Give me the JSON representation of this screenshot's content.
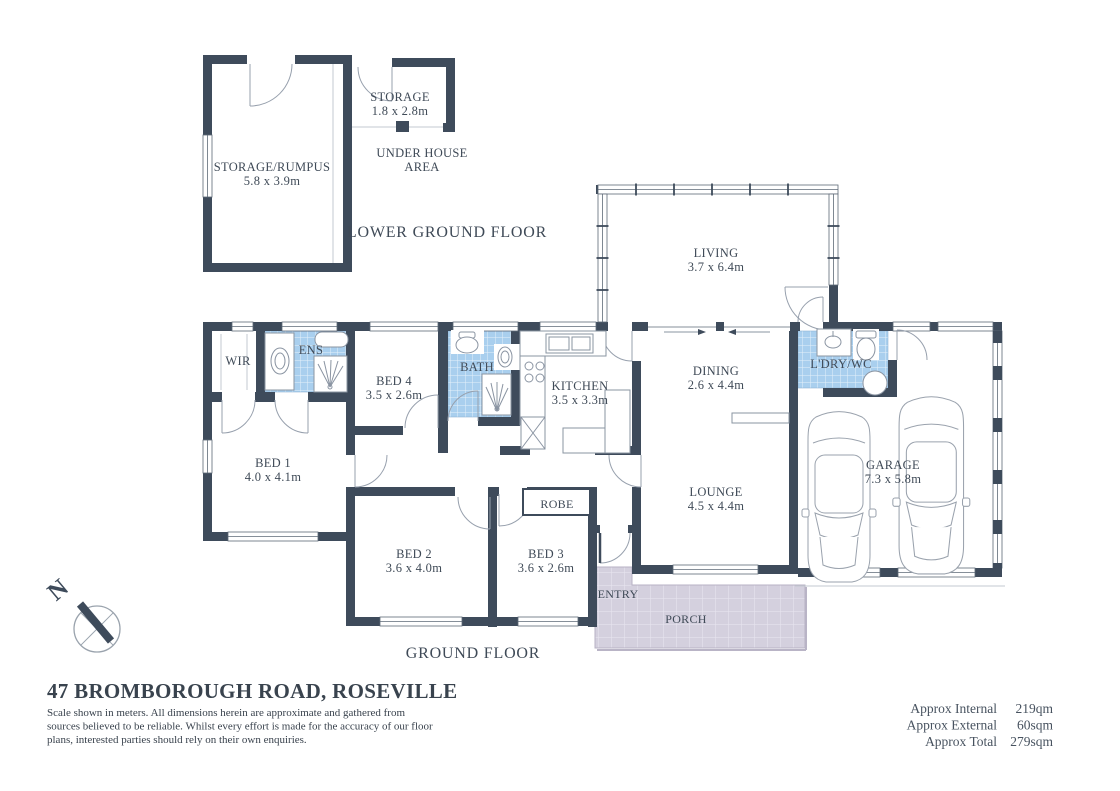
{
  "title": {
    "address": "47 BROMBOROUGH ROAD, ROSEVILLE"
  },
  "disclaimer": {
    "line1": "Scale shown in meters. All dimensions herein are approximate and gathered from",
    "line2": "sources believed to be reliable. Whilst every effort is made for the accuracy of our floor",
    "line3": "plans, interested parties should rely on their own enquiries."
  },
  "area_summary": {
    "internal": {
      "label": "Approx Internal",
      "value": "219qm"
    },
    "external": {
      "label": "Approx External",
      "value": "60sqm"
    },
    "total": {
      "label": "Approx Total",
      "value": "279sqm"
    }
  },
  "floor_labels": {
    "lower": "LOWER GROUND FLOOR",
    "ground": "GROUND FLOOR"
  },
  "compass": {
    "north": "N"
  },
  "rooms": {
    "storage_rumpus": {
      "name": "STORAGE/RUMPUS",
      "dim": "5.8 x 3.9m"
    },
    "storage": {
      "name": "STORAGE",
      "dim": "1.8 x 2.8m"
    },
    "under_house": {
      "line1": "UNDER HOUSE",
      "line2": "AREA"
    },
    "living": {
      "name": "LIVING",
      "dim": "3.7 x 6.4m"
    },
    "dining": {
      "name": "DINING",
      "dim": "2.6 x 4.4m"
    },
    "kitchen": {
      "name": "KITCHEN",
      "dim": "3.5 x 3.3m"
    },
    "lounge": {
      "name": "LOUNGE",
      "dim": "4.5 x 4.4m"
    },
    "garage": {
      "name": "GARAGE",
      "dim": "7.3 x 5.8m"
    },
    "laundry": {
      "name": "L'DRY/WC"
    },
    "bath": {
      "name": "BATH"
    },
    "ens": {
      "name": "ENS"
    },
    "wir": {
      "name": "WIR"
    },
    "robe": {
      "name": "ROBE"
    },
    "bed1": {
      "name": "BED 1",
      "dim": "4.0 x 4.1m"
    },
    "bed2": {
      "name": "BED 2",
      "dim": "3.6 x 4.0m"
    },
    "bed3": {
      "name": "BED 3",
      "dim": "3.6 x 2.6m"
    },
    "bed4": {
      "name": "BED 4",
      "dim": "3.5 x 2.6m"
    },
    "entry": {
      "name": "ENTRY"
    },
    "porch": {
      "name": "PORCH"
    }
  },
  "colors": {
    "wall": "#3E4B5B",
    "label_text": "#3f4a57",
    "tile_blue": "#a9cfee",
    "porch_tile": "#d4d0de"
  }
}
